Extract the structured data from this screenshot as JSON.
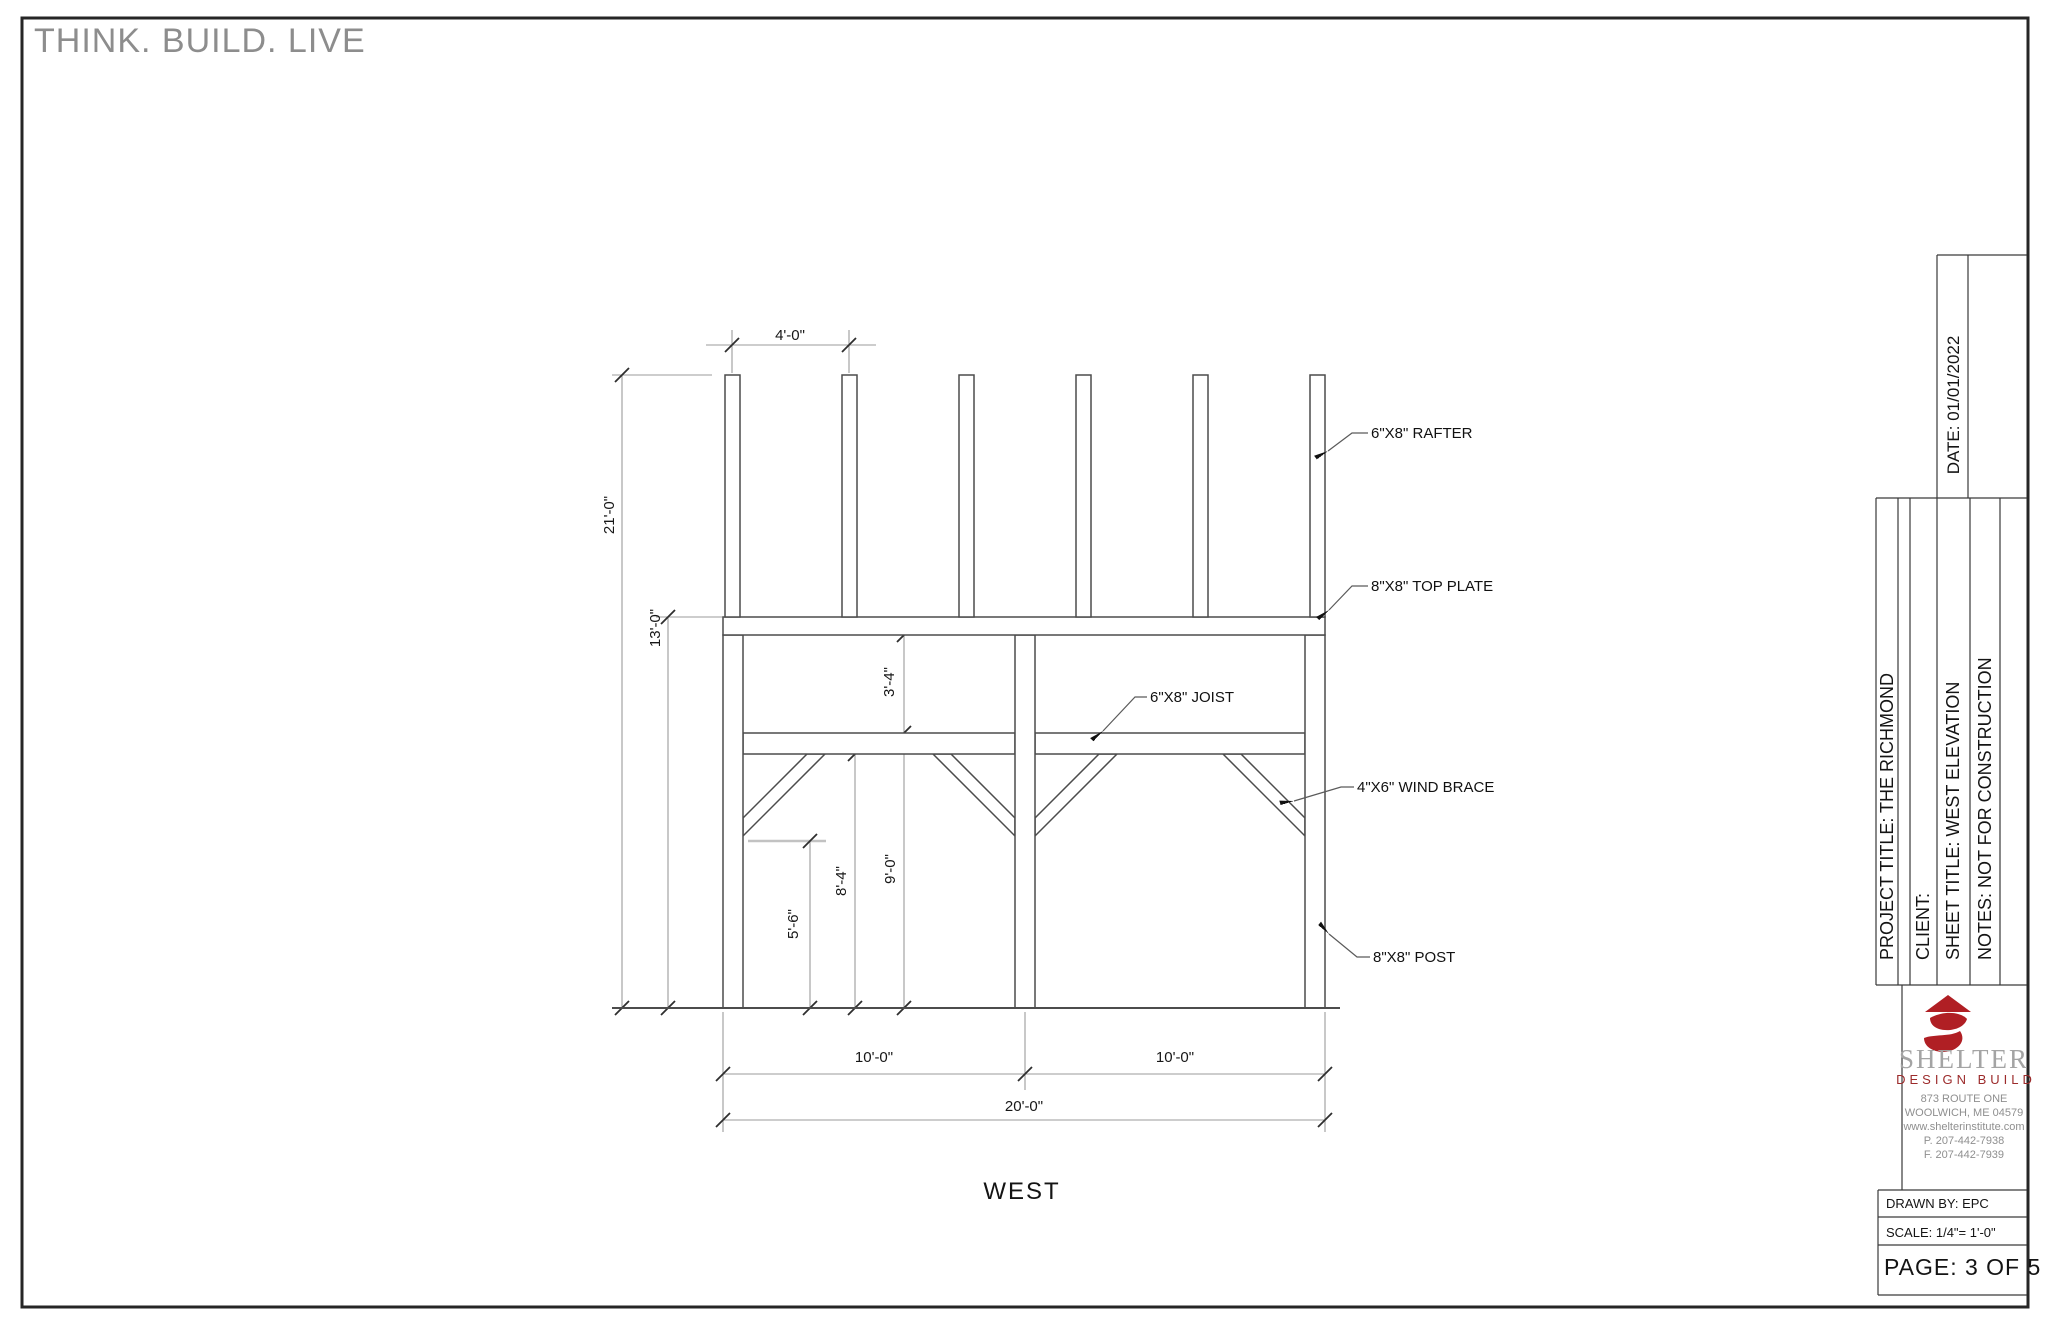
{
  "page": {
    "tagline": "THINK. BUILD. LIVE"
  },
  "drawing": {
    "view_title": "WEST",
    "dims": {
      "rafter_spacing": "4'-0\"",
      "overall_height": "21'-0\"",
      "eave_height": "13'-0\"",
      "plate_to_joist": "3'-4\"",
      "brace_foot_height": "5'-6\"",
      "joist_bottom_height": "8'-4\"",
      "joist_top_height": "9'-0\"",
      "bay_left": "10'-0\"",
      "bay_right": "10'-0\"",
      "overall_width": "20'-0\""
    },
    "labels": {
      "rafter": "6\"X8\" RAFTER",
      "top_plate": "8\"X8\" TOP PLATE",
      "joist": "6\"X8\" JOIST",
      "wind_brace": "4\"X6\" WIND BRACE",
      "post": "8\"X8\" POST"
    }
  },
  "title_block": {
    "date": "DATE:   01/01/2022",
    "project_title": "PROJECT TITLE:  THE RICHMOND",
    "client": "CLIENT:",
    "sheet_title": "SHEET TITLE:  WEST ELEVATION",
    "notes": "NOTES:  NOT FOR CONSTRUCTION",
    "logo": {
      "name": "SHELTER",
      "tagline": "DESIGN BUILD"
    },
    "address_lines": [
      "873 ROUTE ONE",
      "WOOLWICH, ME 04579",
      "www.shelterinstitute.com",
      "P. 207-442-7938",
      "F. 207-442-7939"
    ],
    "drawn_by": "DRAWN BY: EPC",
    "scale": "SCALE:   1/4\"= 1'-0\"",
    "page_number": "PAGE: 3  OF  5",
    "colors": {
      "brand_red": "#b01f24",
      "logo_gray": "#a4a4a4"
    }
  }
}
